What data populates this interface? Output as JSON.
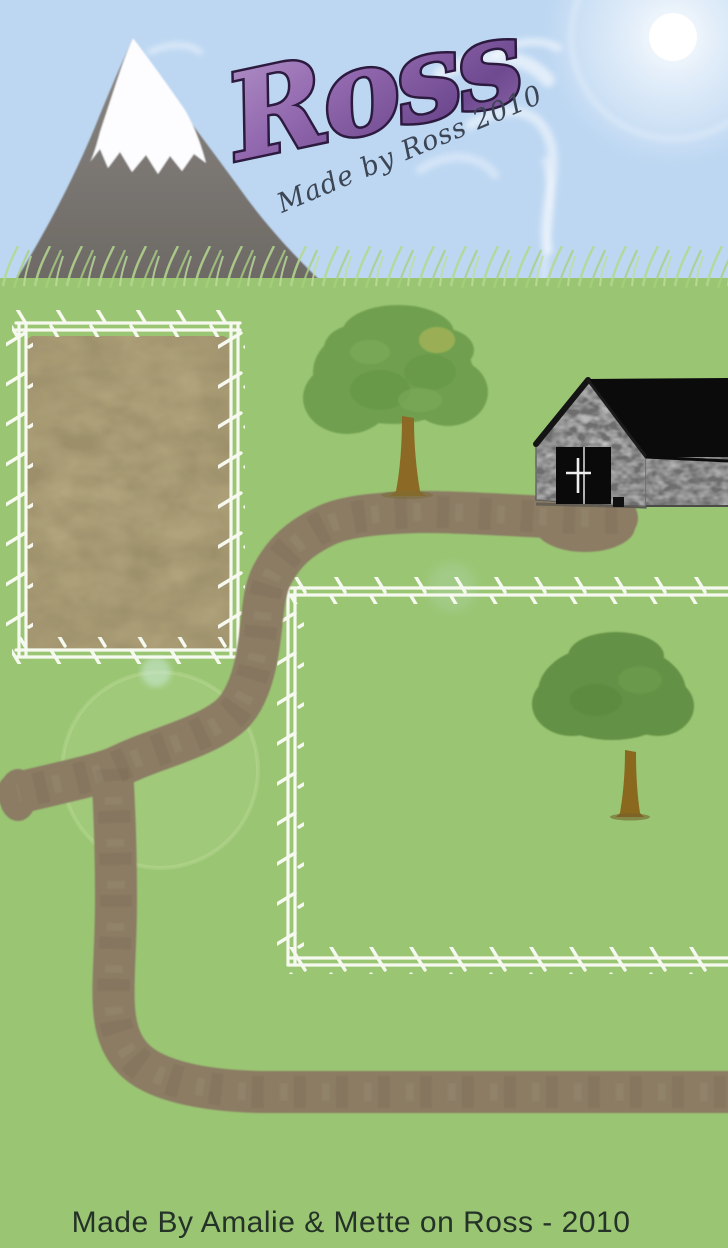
{
  "page": {
    "width": 728,
    "height": 1248
  },
  "header": {
    "logo_text": "Ross",
    "tagline": "Made by Ross 2010"
  },
  "footer": {
    "credit": "Made By Amalie & Mette on Ross - 2010"
  },
  "scene": {
    "features": [
      {
        "name": "sky"
      },
      {
        "name": "sun-with-lens-flare"
      },
      {
        "name": "wispy-clouds"
      },
      {
        "name": "snow-capped-mountain"
      },
      {
        "name": "grass-field"
      },
      {
        "name": "sand-paddock-with-white-fence"
      },
      {
        "name": "grass-paddock-with-white-fence"
      },
      {
        "name": "stone-barn-black-roof-double-doors"
      },
      {
        "name": "tree-left"
      },
      {
        "name": "tree-right-inside-paddock"
      },
      {
        "name": "winding-dirt-path"
      }
    ],
    "colors": {
      "sky": "#bdd7f2",
      "grass": "#9ac573",
      "grass_blades": "#b3d88e",
      "sand": "#b5a880",
      "dirt_path": "#8b7c64",
      "fence_white": "#f6f9ef",
      "mountain_gray": "#7a7672",
      "snow_white": "#fdfdff",
      "barn_wall": "#c6c6c6",
      "barn_roof": "#0b0b0b",
      "tree_canopy_left": "#6fa04f",
      "tree_canopy_right": "#649144",
      "tree_trunk": "#8c6a25",
      "logo_purple": "#9268ae",
      "logo_outline": "#2d1a3f",
      "tagline_ink": "#3c4554",
      "credit_ink": "#243227"
    }
  }
}
